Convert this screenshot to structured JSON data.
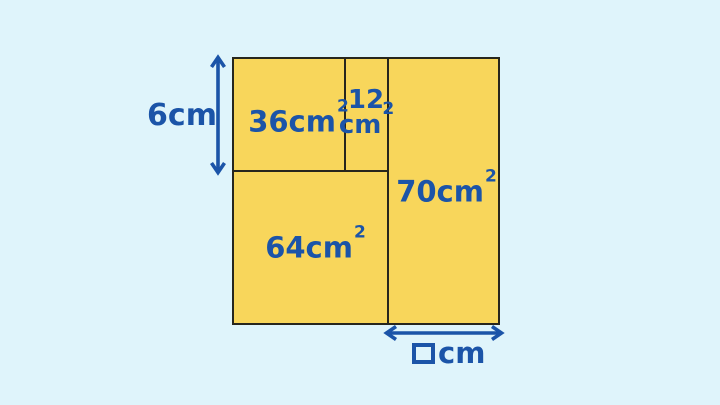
{
  "diagram": {
    "colors": {
      "background": "#DFF4FB",
      "rect_fill": "#F8D65B",
      "rect_border": "#27261D",
      "accent_blue": "#1B54A8"
    },
    "icons": {
      "vertical_double_arrow": "↕",
      "horizontal_double_arrow": "↔",
      "unknown_value_box": "□"
    },
    "regions": [
      {
        "name": "top-left",
        "area": "36cm",
        "sup": "2"
      },
      {
        "name": "top-middle",
        "area_line1": "12",
        "area_line2": "cm",
        "sup": "2"
      },
      {
        "name": "right",
        "area": "70cm",
        "sup": "2"
      },
      {
        "name": "bottom-left",
        "area": "64cm",
        "sup": "2"
      }
    ],
    "dimensions": {
      "left_label": "6cm",
      "bottom_unit": "cm"
    }
  }
}
